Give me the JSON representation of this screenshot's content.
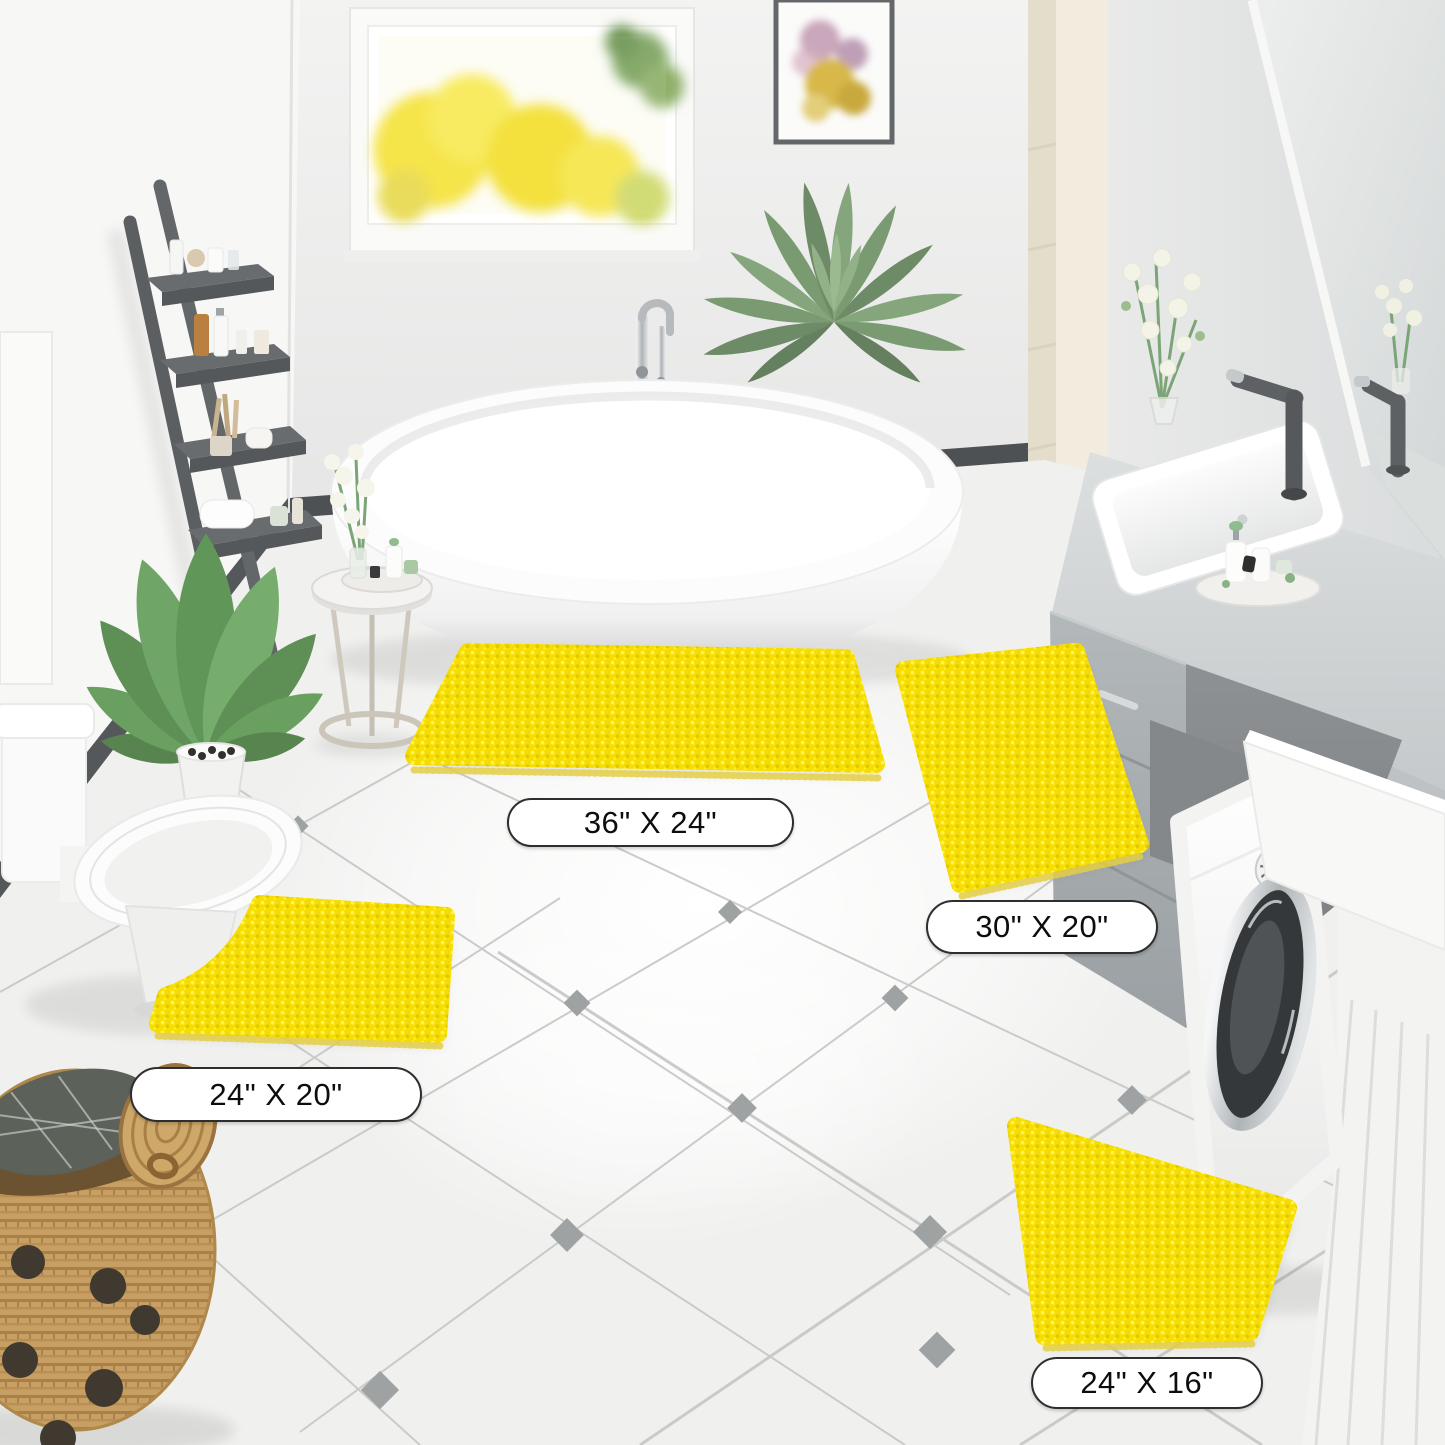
{
  "image_type": "product-photography",
  "scene": {
    "name": "bathroom-scene",
    "description": "Bright bathroom with freestanding tub, gray vanity, washing machine and four yellow chenille bath mats on white diagonal tile floor"
  },
  "product": {
    "item": "chenille bath rug set",
    "pieces": 4,
    "color_name": "yellow",
    "swatch_hex": "#F7DF00"
  },
  "mats": [
    {
      "id": "large-rectangle",
      "shape": "rectangle",
      "size_label": "36\" X 24\""
    },
    {
      "id": "medium-runner",
      "shape": "rectangle",
      "size_label": "30\" X 20\""
    },
    {
      "id": "contour",
      "shape": "u-shaped contour",
      "size_label": "24\" X 20\""
    },
    {
      "id": "small-rectangle",
      "shape": "rectangle",
      "size_label": "24\" X 16\""
    }
  ],
  "palette": {
    "mat_yellow": "#F7DF00",
    "mat_yellow_deep": "#E3C500",
    "mat_fringe": "#E4CF45",
    "wall": "#F2F2F1",
    "floor": "#F0F0EF",
    "tile_line": "#C8C8C7",
    "tile_diamond": "#9FA2A3",
    "baseboard": "#4E5153",
    "cabinet_gray": "#AAB0B3",
    "counter_gray": "#D5D8D9",
    "wicker_tan": "#C79E63",
    "leaf_green": "#6FA068",
    "label_background": "#FFFFFF",
    "label_border": "#2E2E2E",
    "label_text": "#0D0D0D"
  },
  "objects": [
    "window-autumn-view",
    "wall-art",
    "mirror",
    "ladder-shelf",
    "potted-plant",
    "toilet",
    "wicker-basket",
    "freestanding-bathtub",
    "floor-faucet",
    "palm-plant",
    "side-table",
    "flower-vase",
    "vanity-cabinet",
    "sink",
    "washing-machine",
    "tile-floor"
  ]
}
